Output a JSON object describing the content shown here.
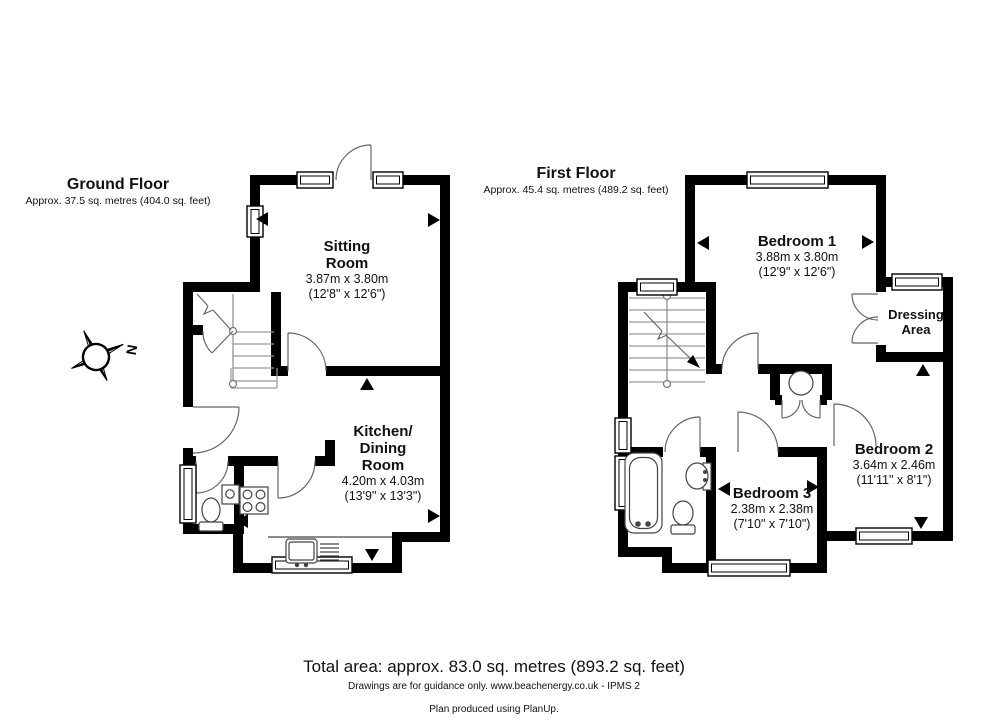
{
  "ground_floor": {
    "title": "Ground Floor",
    "area": "Approx. 37.5 sq. metres (404.0 sq. feet)",
    "rooms": {
      "sitting": {
        "line1": "Sitting",
        "line2": "Room",
        "metric": "3.87m x 3.80m",
        "imperial": "(12'8\" x 12'6\")"
      },
      "kitchen": {
        "line1": "Kitchen/",
        "line2": "Dining",
        "line3": "Room",
        "metric": "4.20m x 4.03m",
        "imperial": "(13'9\" x 13'3\")"
      }
    }
  },
  "first_floor": {
    "title": "First Floor",
    "area": "Approx. 45.4 sq. metres (489.2 sq. feet)",
    "rooms": {
      "bedroom1": {
        "name": "Bedroom 1",
        "metric": "3.88m x 3.80m",
        "imperial": "(12'9\" x 12'6\")"
      },
      "dressing": {
        "line1": "Dressing",
        "line2": "Area"
      },
      "bedroom2": {
        "name": "Bedroom 2",
        "metric": "3.64m x 2.46m",
        "imperial": "(11'11\" x 8'1\")"
      },
      "bedroom3": {
        "name": "Bedroom 3",
        "metric": "2.38m x 2.38m",
        "imperial": "(7'10\" x 7'10\")"
      }
    }
  },
  "compass": {
    "north_label": "N"
  },
  "footer": {
    "total_area": "Total area: approx. 83.0 sq. metres (893.2 sq. feet)",
    "disclaimer": "Drawings are for guidance only. www.beachenergy.co.uk - IPMS 2",
    "credit": "Plan produced using PlanUp."
  },
  "colors": {
    "wall": "#000000",
    "paper": "#ffffff"
  }
}
